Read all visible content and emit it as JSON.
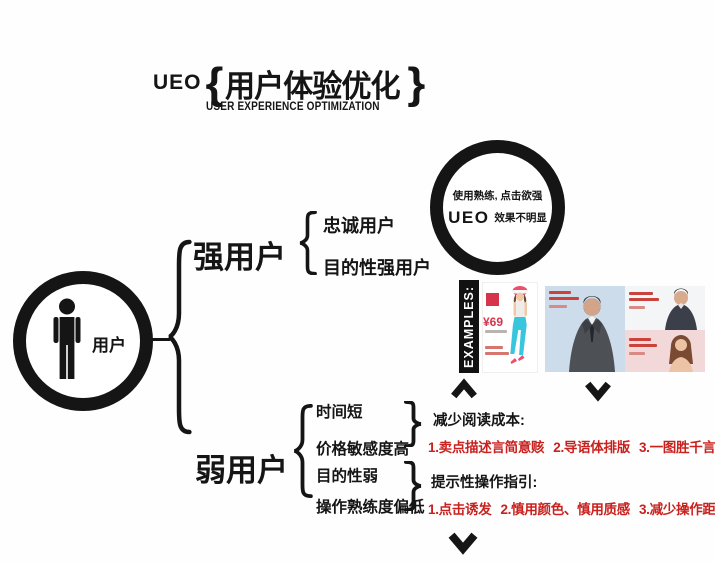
{
  "title": {
    "prefix": "UEO",
    "brace_open": "{",
    "main": "用户体验优化",
    "brace_close": "}",
    "subtitle": "USER EXPERIENCE OPTIMIZATION"
  },
  "user_node": {
    "label": "用户"
  },
  "branches": {
    "strong": {
      "label": "强用户",
      "items": [
        "忠诚用户",
        "目的性强用户"
      ]
    },
    "weak": {
      "label": "弱用户",
      "items": [
        "时间短",
        "价格敏感度高",
        "目的性弱",
        "操作熟练度偏低"
      ]
    }
  },
  "ueo_circle": {
    "line1": "使用熟练, 点击欲强",
    "brand": "UEO",
    "line2": "效果不明显"
  },
  "examples": {
    "label": "EXAMPLES:",
    "product1_price": "¥69"
  },
  "guidance": [
    {
      "heading": "减少阅读成本:",
      "points": [
        "1.卖点描述言简意赅",
        "2.导语体排版",
        "3.一图胜千言"
      ]
    },
    {
      "heading": "提示性操作指引:",
      "points": [
        "1.点击诱发",
        "2.慎用颜色、慎用质感",
        "3.减少操作距离"
      ]
    }
  ],
  "colors": {
    "ink": "#151515",
    "accent_red": "#c9211e",
    "price_red": "#d6344c",
    "cyan_pants": "#38c5de",
    "panel_blue": "#ccdcea",
    "panel_gray": "#f4f5f7",
    "panel_pink": "#f3d8da"
  }
}
